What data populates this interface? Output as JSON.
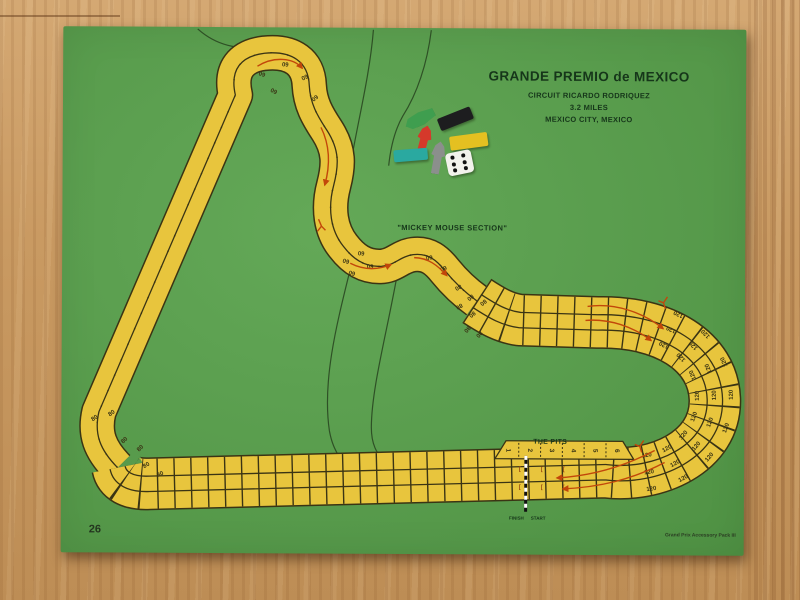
{
  "board": {
    "title": "GRANDE PREMIO de MEXICO",
    "subtitle_circuit": "CIRCUIT RICARDO RODRIQUEZ",
    "subtitle_length": "3.2 MILES",
    "subtitle_city": "MEXICO CITY, MEXICO",
    "section_label": "\"MICKEY MOUSE SECTION\"",
    "pits_label": "THE PITS",
    "pit_numbers": [
      "1",
      "2",
      "3",
      "4",
      "5",
      "6"
    ],
    "finish_label": "FINISH",
    "start_label": "START",
    "page_number": "26",
    "credit": "Grand Prix Accessory Pack III",
    "bracket_glyph": "[",
    "speeds": {
      "hairpin": "60",
      "esses": "60",
      "downhill": "80",
      "corner": "80",
      "right_curve": "120"
    }
  },
  "pieces": {
    "die_pips": 6,
    "items": [
      {
        "name": "green-car",
        "color": "#3f9e4f"
      },
      {
        "name": "black-tile",
        "color": "#1d1d1f"
      },
      {
        "name": "yellow-tile",
        "color": "#e4c021"
      },
      {
        "name": "red-car",
        "color": "#d5392b"
      },
      {
        "name": "teal-tile",
        "color": "#2aa9a0"
      },
      {
        "name": "gray-car",
        "color": "#8b8f8c"
      },
      {
        "name": "white-die",
        "color": "#f2f2ec"
      }
    ]
  },
  "colors": {
    "wood": "#c99a62",
    "board_green": "#58a24b",
    "track_yellow": "#e8c53d",
    "line_dark": "#3a3414",
    "arrow_red": "#c2470a",
    "text_dark": "#16361a"
  }
}
